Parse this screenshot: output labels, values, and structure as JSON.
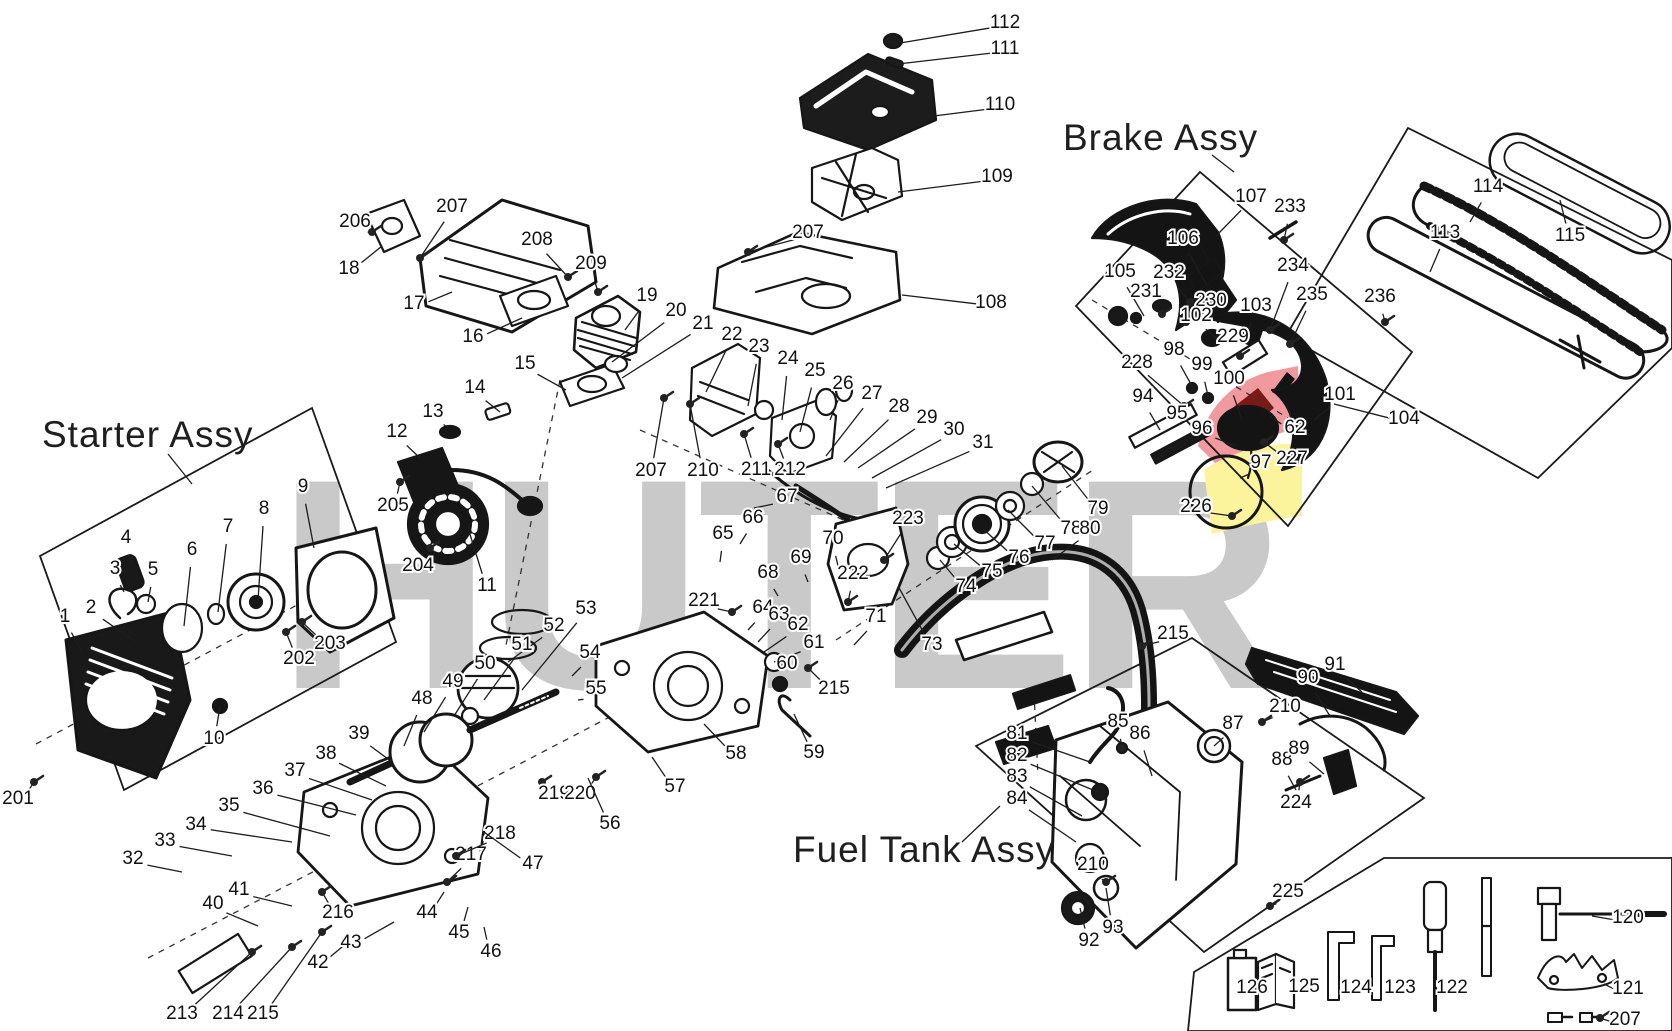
{
  "page": {
    "title": "Chainsaw exploded parts diagram",
    "watermark": "HUTER",
    "assembly_labels": {
      "starter": "Starter Assy",
      "brake": "Brake Assy",
      "fuel_tank": "Fuel Tank Assy"
    },
    "colors": {
      "line": "#161616",
      "watermark_gray": "#c9c9c9",
      "brand_red": "#f09aa0",
      "brand_dark_red": "#7a1a14",
      "brand_yellow": "#fbf49c",
      "background": "#ffffff"
    },
    "part_labels": [
      {
        "n": "112",
        "x": 1005,
        "y": 22,
        "tx": 900,
        "ty": 43
      },
      {
        "n": "111",
        "x": 1005,
        "y": 48,
        "tx": 898,
        "ty": 64
      },
      {
        "n": "110",
        "x": 1000,
        "y": 104,
        "tx": 918,
        "ty": 118
      },
      {
        "n": "109",
        "x": 997,
        "y": 176,
        "tx": 898,
        "ty": 192
      },
      {
        "n": "207",
        "x": 808,
        "y": 232,
        "tx": 748,
        "ty": 252
      },
      {
        "n": "108",
        "x": 991,
        "y": 302,
        "tx": 902,
        "ty": 295
      },
      {
        "n": "206",
        "x": 355,
        "y": 221,
        "tx": 372,
        "ty": 232
      },
      {
        "n": "207",
        "x": 452,
        "y": 206,
        "tx": 420,
        "ty": 258
      },
      {
        "n": "18",
        "x": 349,
        "y": 268,
        "tx": 382,
        "ty": 246
      },
      {
        "n": "17",
        "x": 414,
        "y": 303,
        "tx": 452,
        "ty": 292
      },
      {
        "n": "208",
        "x": 537,
        "y": 239,
        "tx": 568,
        "ty": 277
      },
      {
        "n": "16",
        "x": 473,
        "y": 336,
        "tx": 522,
        "ty": 318
      },
      {
        "n": "209",
        "x": 591,
        "y": 263,
        "tx": 598,
        "ty": 292
      },
      {
        "n": "19",
        "x": 647,
        "y": 295,
        "tx": 625,
        "ty": 330
      },
      {
        "n": "20",
        "x": 676,
        "y": 310,
        "tx": 612,
        "ty": 362
      },
      {
        "n": "21",
        "x": 703,
        "y": 323,
        "tx": 622,
        "ty": 378
      },
      {
        "n": "22",
        "x": 732,
        "y": 334,
        "tx": 706,
        "ty": 392
      },
      {
        "n": "23",
        "x": 759,
        "y": 346,
        "tx": 748,
        "ty": 406
      },
      {
        "n": "24",
        "x": 788,
        "y": 358,
        "tx": 782,
        "ty": 420
      },
      {
        "n": "25",
        "x": 815,
        "y": 370,
        "tx": 800,
        "ty": 432
      },
      {
        "n": "26",
        "x": 843,
        "y": 383,
        "tx": 830,
        "ty": 420
      },
      {
        "n": "27",
        "x": 872,
        "y": 393,
        "tx": 826,
        "ty": 456
      },
      {
        "n": "28",
        "x": 899,
        "y": 406,
        "tx": 844,
        "ty": 462
      },
      {
        "n": "29",
        "x": 927,
        "y": 417,
        "tx": 858,
        "ty": 468
      },
      {
        "n": "30",
        "x": 954,
        "y": 429,
        "tx": 872,
        "ty": 478
      },
      {
        "n": "31",
        "x": 983,
        "y": 442,
        "tx": 886,
        "ty": 488
      },
      {
        "n": "15",
        "x": 525,
        "y": 363,
        "tx": 566,
        "ty": 390
      },
      {
        "n": "14",
        "x": 475,
        "y": 387,
        "tx": 500,
        "ty": 412
      },
      {
        "n": "13",
        "x": 433,
        "y": 411,
        "tx": 452,
        "ty": 430
      },
      {
        "n": "12",
        "x": 397,
        "y": 431,
        "tx": 420,
        "ty": 458
      },
      {
        "n": "205",
        "x": 393,
        "y": 505,
        "tx": 400,
        "ty": 482
      },
      {
        "n": "204",
        "x": 418,
        "y": 565,
        "tx": 430,
        "ty": 548
      },
      {
        "n": "11",
        "x": 487,
        "y": 585,
        "tx": 468,
        "ty": 528
      },
      {
        "n": "207",
        "x": 651,
        "y": 470,
        "tx": 664,
        "ty": 398
      },
      {
        "n": "210",
        "x": 703,
        "y": 470,
        "tx": 690,
        "ty": 404
      },
      {
        "n": "211",
        "x": 756,
        "y": 469,
        "tx": 744,
        "ty": 434
      },
      {
        "n": "212",
        "x": 790,
        "y": 469,
        "tx": 778,
        "ty": 444
      },
      {
        "n": "67",
        "x": 787,
        "y": 496,
        "tx": 754,
        "ty": 508
      },
      {
        "n": "66",
        "x": 753,
        "y": 517,
        "tx": 740,
        "ty": 544
      },
      {
        "n": "65",
        "x": 723,
        "y": 533,
        "tx": 720,
        "ty": 562
      },
      {
        "n": "70",
        "x": 833,
        "y": 538,
        "tx": 838,
        "ty": 566
      },
      {
        "n": "69",
        "x": 801,
        "y": 557,
        "tx": 808,
        "ty": 582
      },
      {
        "n": "68",
        "x": 768,
        "y": 572,
        "tx": 778,
        "ty": 596
      },
      {
        "n": "221",
        "x": 704,
        "y": 600,
        "tx": 732,
        "ty": 612
      },
      {
        "n": "64",
        "x": 763,
        "y": 607,
        "tx": 748,
        "ty": 630
      },
      {
        "n": "63",
        "x": 779,
        "y": 614,
        "tx": 758,
        "ty": 642
      },
      {
        "n": "62",
        "x": 798,
        "y": 624,
        "tx": 764,
        "ty": 652
      },
      {
        "n": "61",
        "x": 814,
        "y": 642,
        "tx": 774,
        "ty": 662
      },
      {
        "n": "60",
        "x": 787,
        "y": 663,
        "tx": 780,
        "ty": 682
      },
      {
        "n": "215",
        "x": 834,
        "y": 688,
        "tx": 808,
        "ty": 668
      },
      {
        "n": "222",
        "x": 853,
        "y": 573,
        "tx": 848,
        "ty": 602
      },
      {
        "n": "71",
        "x": 876,
        "y": 616,
        "tx": 854,
        "ty": 645
      },
      {
        "n": "73",
        "x": 932,
        "y": 644,
        "tx": 898,
        "ty": 586
      },
      {
        "n": "223",
        "x": 908,
        "y": 518,
        "tx": 884,
        "ty": 560
      },
      {
        "n": "74",
        "x": 966,
        "y": 586,
        "tx": 940,
        "ty": 560
      },
      {
        "n": "75",
        "x": 992,
        "y": 571,
        "tx": 954,
        "ty": 544
      },
      {
        "n": "76",
        "x": 1019,
        "y": 557,
        "tx": 982,
        "ty": 528
      },
      {
        "n": "77",
        "x": 1045,
        "y": 543,
        "tx": 1008,
        "ty": 510
      },
      {
        "n": "78",
        "x": 1071,
        "y": 528,
        "tx": 1032,
        "ty": 486
      },
      {
        "n": "79",
        "x": 1098,
        "y": 508,
        "tx": 1062,
        "ty": 466
      },
      {
        "n": "80",
        "x": 1090,
        "y": 528,
        "tx": 1052,
        "ty": 560
      },
      {
        "n": "53",
        "x": 586,
        "y": 608,
        "tx": 522,
        "ty": 690
      },
      {
        "n": "52",
        "x": 554,
        "y": 625,
        "tx": 508,
        "ty": 662
      },
      {
        "n": "51",
        "x": 522,
        "y": 644,
        "tx": 484,
        "ty": 700
      },
      {
        "n": "54",
        "x": 590,
        "y": 652,
        "tx": 572,
        "ty": 676
      },
      {
        "n": "50",
        "x": 485,
        "y": 663,
        "tx": 454,
        "ty": 716
      },
      {
        "n": "49",
        "x": 453,
        "y": 681,
        "tx": 424,
        "ty": 732
      },
      {
        "n": "55",
        "x": 596,
        "y": 688,
        "tx": 578,
        "ty": 700
      },
      {
        "n": "48",
        "x": 422,
        "y": 698,
        "tx": 404,
        "ty": 746
      },
      {
        "n": "39",
        "x": 359,
        "y": 733,
        "tx": 392,
        "ty": 762
      },
      {
        "n": "38",
        "x": 326,
        "y": 753,
        "tx": 386,
        "ty": 786
      },
      {
        "n": "37",
        "x": 295,
        "y": 770,
        "tx": 372,
        "ty": 800
      },
      {
        "n": "36",
        "x": 263,
        "y": 788,
        "tx": 356,
        "ty": 815
      },
      {
        "n": "35",
        "x": 229,
        "y": 805,
        "tx": 330,
        "ty": 836
      },
      {
        "n": "34",
        "x": 196,
        "y": 824,
        "tx": 292,
        "ty": 842
      },
      {
        "n": "33",
        "x": 165,
        "y": 840,
        "tx": 232,
        "ty": 856
      },
      {
        "n": "32",
        "x": 133,
        "y": 858,
        "tx": 182,
        "ty": 872
      },
      {
        "n": "41",
        "x": 239,
        "y": 889,
        "tx": 292,
        "ty": 906
      },
      {
        "n": "40",
        "x": 213,
        "y": 903,
        "tx": 258,
        "ty": 926
      },
      {
        "n": "216",
        "x": 338,
        "y": 912,
        "tx": 322,
        "ty": 892
      },
      {
        "n": "217",
        "x": 471,
        "y": 854,
        "tx": 447,
        "ty": 882
      },
      {
        "n": "218",
        "x": 500,
        "y": 833,
        "tx": 456,
        "ty": 856
      },
      {
        "n": "47",
        "x": 533,
        "y": 863,
        "tx": 484,
        "ty": 832
      },
      {
        "n": "219",
        "x": 554,
        "y": 793,
        "tx": 542,
        "ty": 782
      },
      {
        "n": "220",
        "x": 580,
        "y": 793,
        "tx": 596,
        "ty": 777
      },
      {
        "n": "56",
        "x": 610,
        "y": 823,
        "tx": 588,
        "ty": 778
      },
      {
        "n": "57",
        "x": 675,
        "y": 786,
        "tx": 652,
        "ty": 757
      },
      {
        "n": "58",
        "x": 736,
        "y": 753,
        "tx": 704,
        "ty": 724
      },
      {
        "n": "59",
        "x": 814,
        "y": 752,
        "tx": 794,
        "ty": 714
      },
      {
        "n": "213",
        "x": 182,
        "y": 1013,
        "tx": 252,
        "ty": 952
      },
      {
        "n": "214",
        "x": 228,
        "y": 1013,
        "tx": 292,
        "ty": 947
      },
      {
        "n": "215",
        "x": 263,
        "y": 1013,
        "tx": 322,
        "ty": 932
      },
      {
        "n": "42",
        "x": 318,
        "y": 962,
        "tx": 348,
        "ty": 942
      },
      {
        "n": "43",
        "x": 351,
        "y": 942,
        "tx": 394,
        "ty": 922
      },
      {
        "n": "44",
        "x": 427,
        "y": 912,
        "tx": 444,
        "ty": 892
      },
      {
        "n": "45",
        "x": 459,
        "y": 932,
        "tx": 468,
        "ty": 907
      },
      {
        "n": "46",
        "x": 491,
        "y": 951,
        "tx": 484,
        "ty": 927
      },
      {
        "n": "9",
        "x": 303,
        "y": 486,
        "tx": 314,
        "ty": 548
      },
      {
        "n": "8",
        "x": 264,
        "y": 508,
        "tx": 258,
        "ty": 600
      },
      {
        "n": "7",
        "x": 228,
        "y": 526,
        "tx": 218,
        "ty": 612
      },
      {
        "n": "6",
        "x": 192,
        "y": 549,
        "tx": 184,
        "ty": 626
      },
      {
        "n": "5",
        "x": 153,
        "y": 569,
        "tx": 148,
        "ty": 602
      },
      {
        "n": "4",
        "x": 126,
        "y": 537,
        "tx": 132,
        "ty": 566
      },
      {
        "n": "3",
        "x": 115,
        "y": 568,
        "tx": 124,
        "ty": 592
      },
      {
        "n": "2",
        "x": 91,
        "y": 607,
        "tx": 136,
        "ty": 642
      },
      {
        "n": "1",
        "x": 65,
        "y": 616,
        "tx": 82,
        "ty": 652
      },
      {
        "n": "10",
        "x": 214,
        "y": 738,
        "tx": 220,
        "ty": 706
      },
      {
        "n": "202",
        "x": 299,
        "y": 658,
        "tx": 286,
        "ty": 632
      },
      {
        "n": "203",
        "x": 330,
        "y": 643,
        "tx": 302,
        "ty": 622
      },
      {
        "n": "201",
        "x": 18,
        "y": 798,
        "tx": 34,
        "ty": 782
      },
      {
        "n": "107",
        "x": 1251,
        "y": 196,
        "tx": 1216,
        "ty": 236
      },
      {
        "n": "233",
        "x": 1290,
        "y": 206,
        "tx": 1284,
        "ty": 240
      },
      {
        "n": "106",
        "x": 1183,
        "y": 238,
        "tx": 1206,
        "ty": 284
      },
      {
        "n": "105",
        "x": 1120,
        "y": 271,
        "tx": 1144,
        "ty": 316
      },
      {
        "n": "232",
        "x": 1169,
        "y": 272,
        "tx": 1190,
        "ty": 302
      },
      {
        "n": "231",
        "x": 1146,
        "y": 291,
        "tx": 1162,
        "ty": 314
      },
      {
        "n": "230",
        "x": 1211,
        "y": 300,
        "tx": 1186,
        "ty": 322
      },
      {
        "n": "102",
        "x": 1196,
        "y": 315,
        "tx": 1218,
        "ty": 340
      },
      {
        "n": "103",
        "x": 1256,
        "y": 305,
        "tx": 1248,
        "ty": 330
      },
      {
        "n": "234",
        "x": 1293,
        "y": 265,
        "tx": 1270,
        "ty": 330
      },
      {
        "n": "235",
        "x": 1312,
        "y": 294,
        "tx": 1290,
        "ty": 344
      },
      {
        "n": "229",
        "x": 1233,
        "y": 336,
        "tx": 1240,
        "ty": 356
      },
      {
        "n": "98",
        "x": 1174,
        "y": 349,
        "tx": 1192,
        "ty": 386
      },
      {
        "n": "228",
        "x": 1137,
        "y": 362,
        "tx": 1184,
        "ty": 406
      },
      {
        "n": "99",
        "x": 1202,
        "y": 364,
        "tx": 1208,
        "ty": 396
      },
      {
        "n": "100",
        "x": 1229,
        "y": 378,
        "tx": 1242,
        "ty": 420
      },
      {
        "n": "94",
        "x": 1143,
        "y": 396,
        "tx": 1160,
        "ty": 430
      },
      {
        "n": "95",
        "x": 1177,
        "y": 413,
        "tx": 1212,
        "ty": 432
      },
      {
        "n": "96",
        "x": 1202,
        "y": 428,
        "tx": 1236,
        "ty": 446
      },
      {
        "n": "62",
        "x": 1295,
        "y": 427,
        "tx": 1270,
        "ty": 416
      },
      {
        "n": "101",
        "x": 1340,
        "y": 394,
        "tx": 1314,
        "ty": 420
      },
      {
        "n": "227",
        "x": 1292,
        "y": 458,
        "tx": 1264,
        "ty": 442
      },
      {
        "n": "97",
        "x": 1261,
        "y": 462,
        "tx": 1240,
        "ty": 478
      },
      {
        "n": "226",
        "x": 1196,
        "y": 506,
        "tx": 1232,
        "ty": 516
      },
      {
        "n": "104",
        "x": 1404,
        "y": 418,
        "tx": 1334,
        "ty": 404
      },
      {
        "n": "114",
        "x": 1488,
        "y": 186,
        "tx": 1470,
        "ty": 222
      },
      {
        "n": "113",
        "x": 1445,
        "y": 232,
        "tx": 1430,
        "ty": 272
      },
      {
        "n": "115",
        "x": 1570,
        "y": 235,
        "tx": 1560,
        "ty": 200
      },
      {
        "n": "236",
        "x": 1380,
        "y": 296,
        "tx": 1385,
        "ty": 322
      },
      {
        "n": "81",
        "x": 1017,
        "y": 733,
        "tx": 1090,
        "ty": 762
      },
      {
        "n": "82",
        "x": 1017,
        "y": 755,
        "tx": 1098,
        "ty": 792
      },
      {
        "n": "83",
        "x": 1017,
        "y": 776,
        "tx": 1082,
        "ty": 816
      },
      {
        "n": "84",
        "x": 1017,
        "y": 798,
        "tx": 1076,
        "ty": 842
      },
      {
        "n": "85",
        "x": 1118,
        "y": 721,
        "tx": 1122,
        "ty": 746
      },
      {
        "n": "86",
        "x": 1140,
        "y": 733,
        "tx": 1152,
        "ty": 776
      },
      {
        "n": "87",
        "x": 1233,
        "y": 723,
        "tx": 1214,
        "ty": 746
      },
      {
        "n": "210",
        "x": 1285,
        "y": 706,
        "tx": 1262,
        "ty": 722
      },
      {
        "n": "90",
        "x": 1308,
        "y": 677,
        "tx": 1330,
        "ty": 716
      },
      {
        "n": "91",
        "x": 1335,
        "y": 664,
        "tx": 1362,
        "ty": 692
      },
      {
        "n": "88",
        "x": 1282,
        "y": 759,
        "tx": 1296,
        "ty": 790
      },
      {
        "n": "89",
        "x": 1299,
        "y": 748,
        "tx": 1324,
        "ty": 774
      },
      {
        "n": "224",
        "x": 1296,
        "y": 802,
        "tx": 1300,
        "ty": 782
      },
      {
        "n": "225",
        "x": 1288,
        "y": 891,
        "tx": 1270,
        "ty": 906
      },
      {
        "n": "210",
        "x": 1093,
        "y": 864,
        "tx": 1106,
        "ty": 882
      },
      {
        "n": "92",
        "x": 1089,
        "y": 940,
        "tx": 1080,
        "ty": 908
      },
      {
        "n": "93",
        "x": 1113,
        "y": 927,
        "tx": 1106,
        "ty": 888
      },
      {
        "n": "215",
        "x": 1173,
        "y": 633,
        "tx": 1142,
        "ty": 646
      },
      {
        "n": "126",
        "x": 1252,
        "y": 987,
        "tx": 1236,
        "ty": 986
      },
      {
        "n": "125",
        "x": 1304,
        "y": 986,
        "tx": 1286,
        "ty": 986
      },
      {
        "n": "124",
        "x": 1356,
        "y": 987,
        "tx": 1340,
        "ty": 986
      },
      {
        "n": "123",
        "x": 1400,
        "y": 987,
        "tx": 1386,
        "ty": 986
      },
      {
        "n": "122",
        "x": 1452,
        "y": 987,
        "tx": 1436,
        "ty": 986
      },
      {
        "n": "120",
        "x": 1628,
        "y": 917,
        "tx": 1592,
        "ty": 916
      },
      {
        "n": "121",
        "x": 1628,
        "y": 988,
        "tx": 1604,
        "ty": 984
      },
      {
        "n": "207",
        "x": 1625,
        "y": 1019,
        "tx": 1600,
        "ty": 1018
      }
    ]
  }
}
